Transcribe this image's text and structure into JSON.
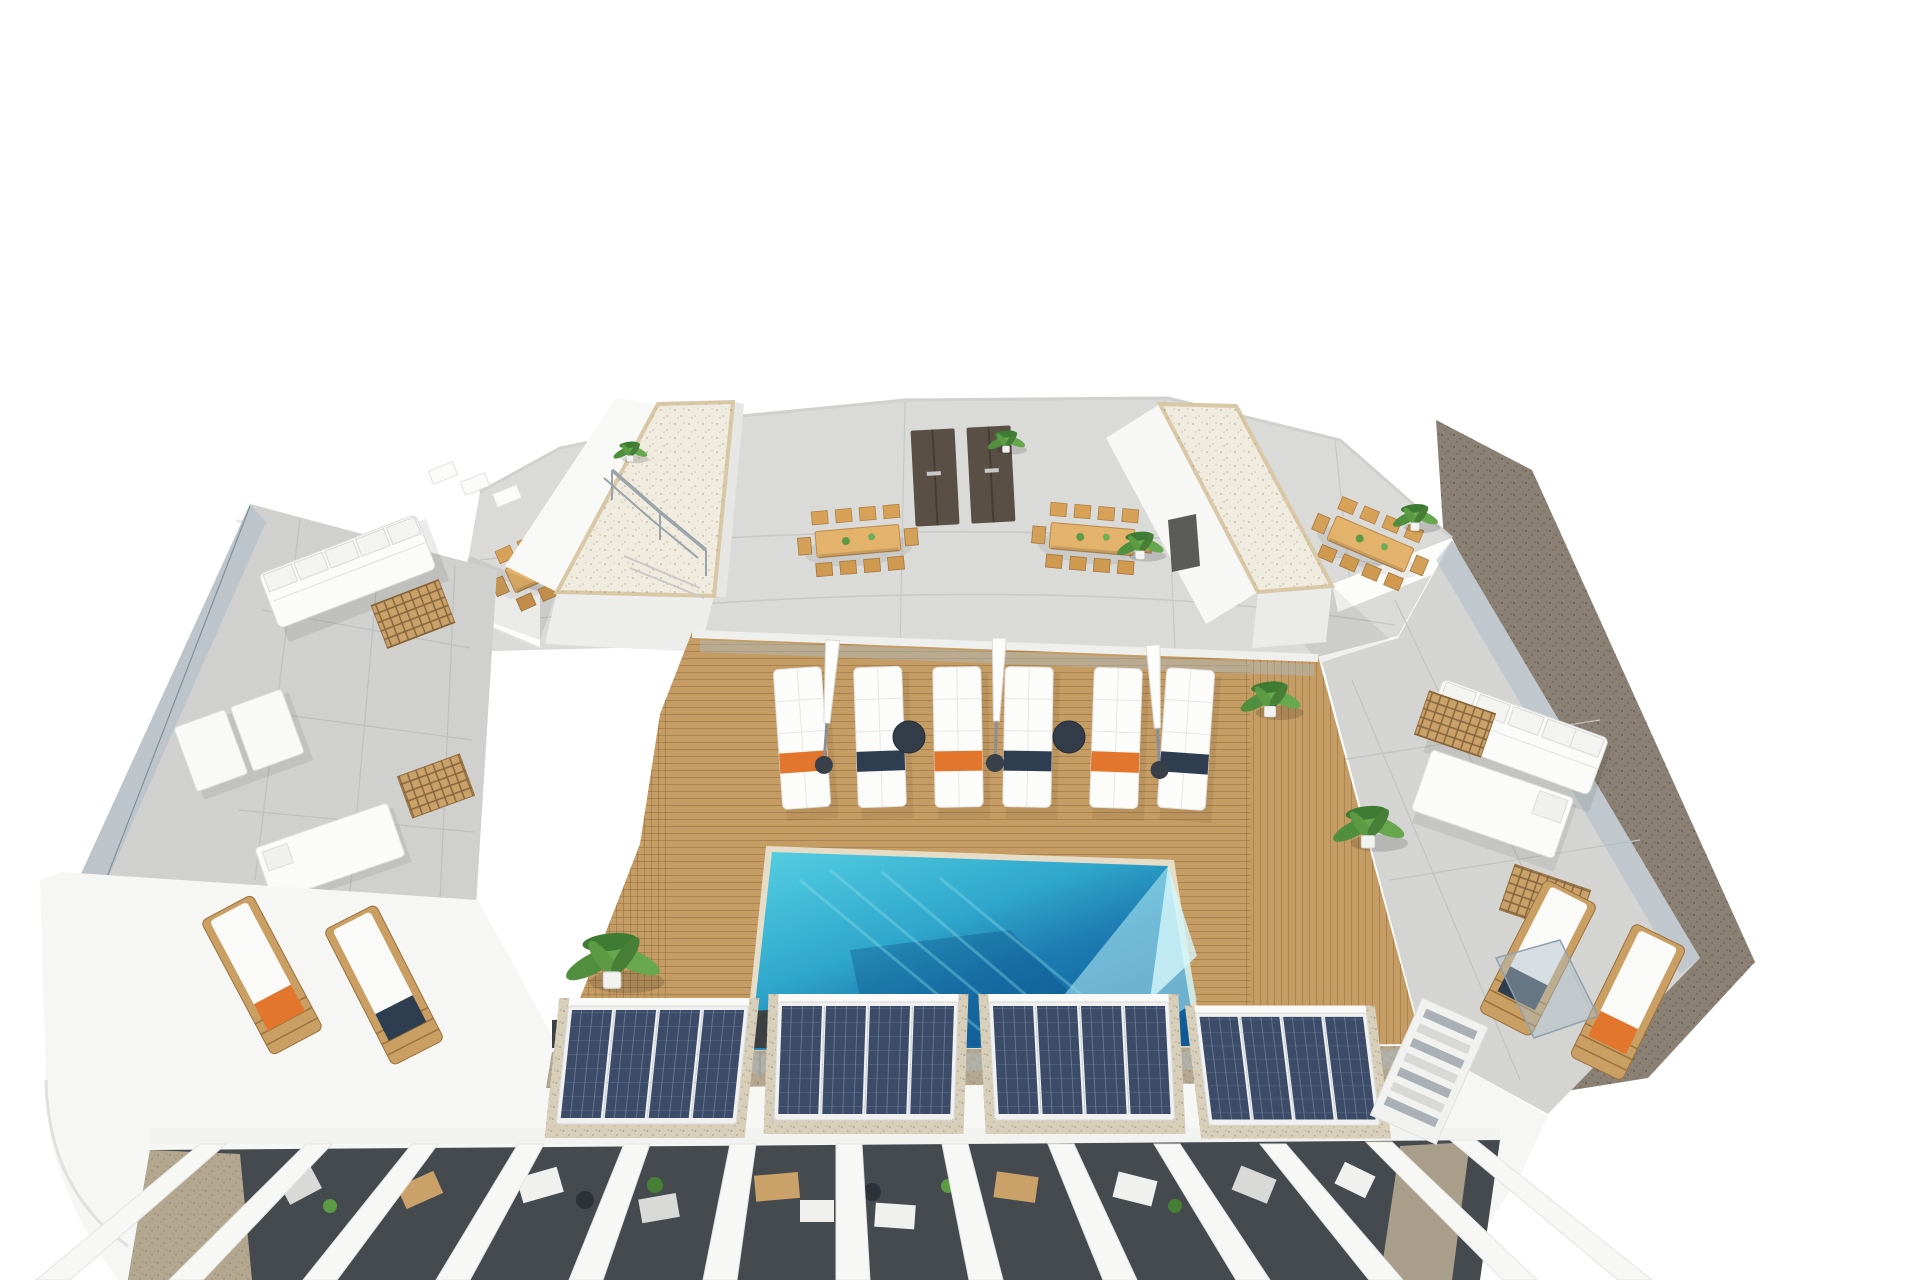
{
  "scene": {
    "type": "3d-architectural-render",
    "view": "aerial-birdseye",
    "subject": "rooftop terrace of a residential building with swimming pool, wooden deck, sun loungers, dining areas, solar panels and pergolas",
    "background": "#ffffff"
  },
  "palette": {
    "bg": "#ffffff",
    "upper_terrace": "#dadad8",
    "terrace_left": "#d0d1ce",
    "terrace_right": "#d4d4d2",
    "deck_wood": "#c59c63",
    "deck_plank_line": "#a8814f",
    "pool_light": "#55cfe2",
    "pool_mid": "#2fa6cb",
    "pool_deep": "#1d7cb2",
    "pool_dark": "#0f5a95",
    "pool_highlight": "#b8f0f7",
    "gravel_roof": "#f0ebdf",
    "gravel_frame": "#d8c8a6",
    "gravel_pad": "#d8cfbb",
    "gravel_ground": "#b4a78f",
    "street_gravel": "#8a8074",
    "solar_blue": "#3c4c68",
    "solar_grid": "#8fa0bf",
    "towel_orange": "#e2762c",
    "towel_navy": "#2e3d4f",
    "furniture_white": "#fbfbfa",
    "wood_furniture": "#c99f63",
    "door_brown": "#5a4f44",
    "glass": "#aebcc7",
    "metal": "#9aa4ab",
    "plant_green": "#5c9a44",
    "plant_green_dark": "#3f7c33",
    "pergola_shadow": "#454a4f"
  },
  "inventory": {
    "pool": {
      "count": 1,
      "shape": "rectangular",
      "water_colors": [
        "#55cfe2",
        "#0f5a95"
      ]
    },
    "deck_double_sun_loungers": {
      "count": 6,
      "orange_towels": 3,
      "navy_towels": 3
    },
    "closed_parasols": {
      "count": 3
    },
    "round_side_tables": {
      "count": 2
    },
    "dining_sets": {
      "count": 4,
      "chairs_per_set": 8
    },
    "roof_towers_with_gravel_top": {
      "count": 2
    },
    "double_doors": {
      "count": 2
    },
    "solar_panel_arrays": {
      "count": 4,
      "modules_per_array": 4
    },
    "corner_wood_loungers_left": {
      "count": 2
    },
    "corner_wood_loungers_right": {
      "count": 2
    },
    "sofa_lounge_areas": {
      "count": 2
    },
    "daybeds": {
      "count": 3
    },
    "wooden_deck_grilles": {
      "count": 4
    },
    "potted_plants": {
      "count": 8
    },
    "pergola_patios": {
      "count": 10
    },
    "staircase": {
      "count": 1
    }
  }
}
